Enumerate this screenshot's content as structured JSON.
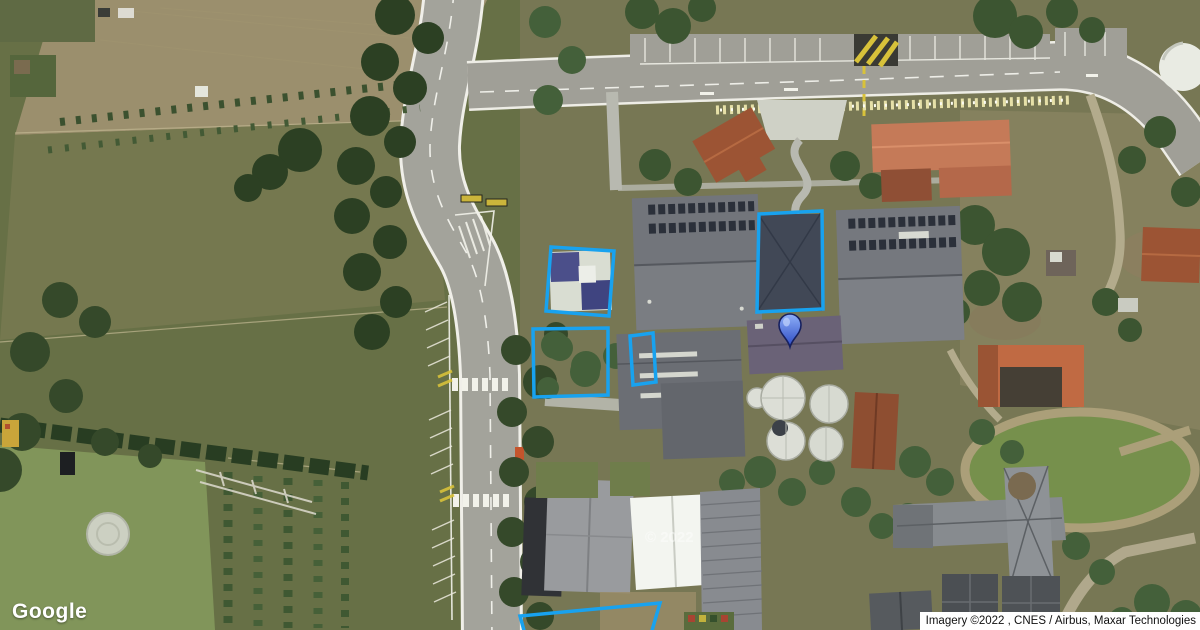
{
  "page": {
    "kind": "satellite-map-view",
    "width": 1200,
    "height": 630
  },
  "branding": {
    "logo": "Google"
  },
  "attribution": {
    "text": "Imagery ©2022 , CNES / Airbus, Maxar Technologies"
  },
  "watermark": {
    "text": "© 2022"
  },
  "overlays": {
    "stroke_color": "#18a2ef",
    "stroke_width": 3.5,
    "polygons": [
      {
        "id": "hall-northwest",
        "points": [
          [
            551,
            247
          ],
          [
            614,
            251
          ],
          [
            609,
            316
          ],
          [
            546,
            311
          ]
        ]
      },
      {
        "id": "yard-west",
        "points": [
          [
            533,
            329
          ],
          [
            608,
            328
          ],
          [
            608,
            395
          ],
          [
            534,
            397
          ]
        ]
      },
      {
        "id": "yard-small",
        "points": [
          [
            630,
            336
          ],
          [
            653,
            333
          ],
          [
            656,
            382
          ],
          [
            633,
            385
          ]
        ]
      },
      {
        "id": "building-dark-roof",
        "points": [
          [
            759,
            214
          ],
          [
            822,
            211
          ],
          [
            823,
            309
          ],
          [
            757,
            312
          ]
        ]
      },
      {
        "id": "yard-south-partial",
        "points": [
          [
            525,
            634
          ],
          [
            520,
            616
          ],
          [
            660,
            603
          ],
          [
            651,
            634
          ]
        ]
      }
    ],
    "marker": {
      "x": 790,
      "y": 347,
      "color_top": "#8fb0f8",
      "color_bottom": "#2b49c3",
      "outline": "#16205f",
      "highlight": "#bdd0fb"
    }
  }
}
